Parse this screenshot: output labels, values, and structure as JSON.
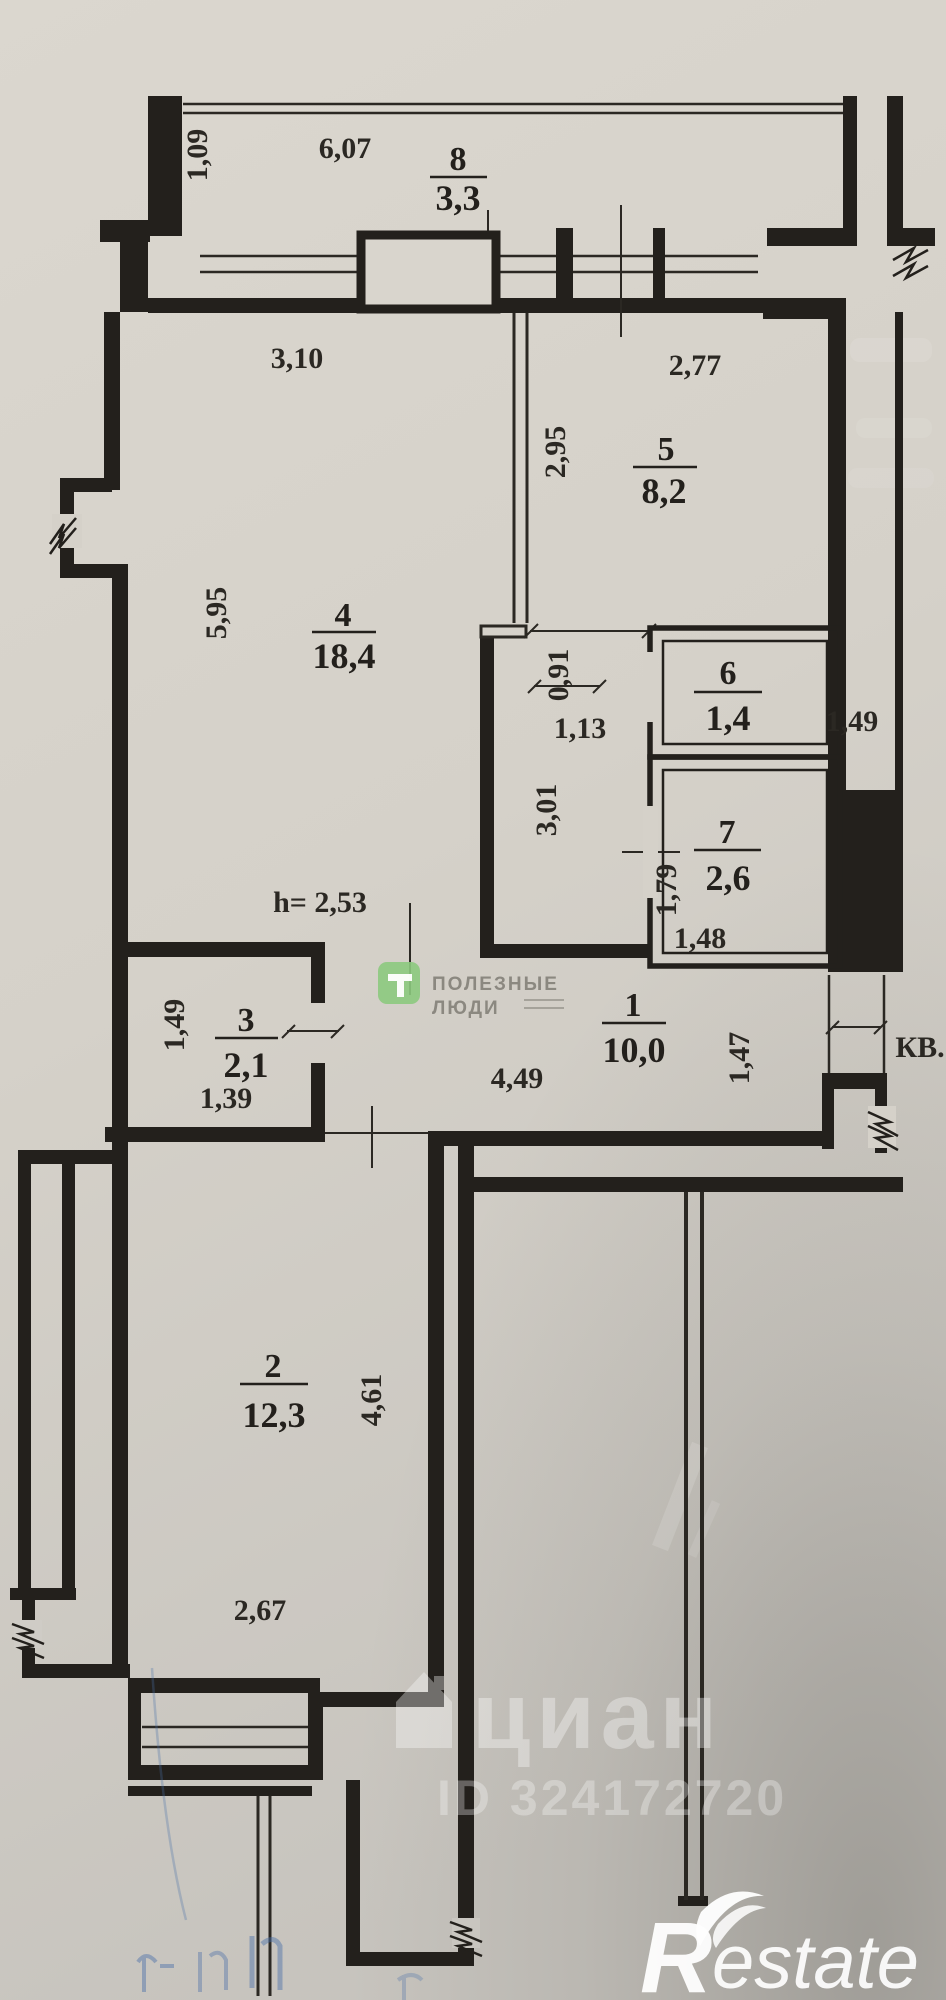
{
  "plan": {
    "rooms": {
      "1": {
        "number": "1",
        "area": "10,0"
      },
      "2": {
        "number": "2",
        "area": "12,3"
      },
      "3": {
        "number": "3",
        "area": "2,1"
      },
      "4": {
        "number": "4",
        "area": "18,4"
      },
      "5": {
        "number": "5",
        "area": "8,2"
      },
      "6": {
        "number": "6",
        "area": "1,4"
      },
      "7": {
        "number": "7",
        "area": "2,6"
      },
      "8": {
        "number": "8",
        "area": "3,3"
      }
    },
    "dims": {
      "balcony_depth": "1,09",
      "balcony_width": "6,07",
      "room4_top": "3,10",
      "room5_top": "2,77",
      "room5_side": "2,95",
      "room4_side": "5,95",
      "corridor_top": "1,13",
      "room6_door": "0,91",
      "room6_width": "1,49",
      "corridor_side": "3,01",
      "ceiling_height": "h= 2,53",
      "room7_side": "1,79",
      "room7_bottom": "1,48",
      "room3_side": "1,49",
      "room3_bottom": "1,39",
      "hall_bottom": "4,49",
      "entry_side": "1,47",
      "room2_side": "4,61",
      "room2_bottom": "2,67",
      "entry_label": "КВ."
    },
    "watermarks": {
      "helpers_line1": "ПОЛЕЗНЫЕ",
      "helpers_line2": "ЛЮДИ",
      "cian": "циан",
      "cian_id": "ID 324172720",
      "restate_r": "R",
      "restate_suffix": "estate"
    }
  }
}
